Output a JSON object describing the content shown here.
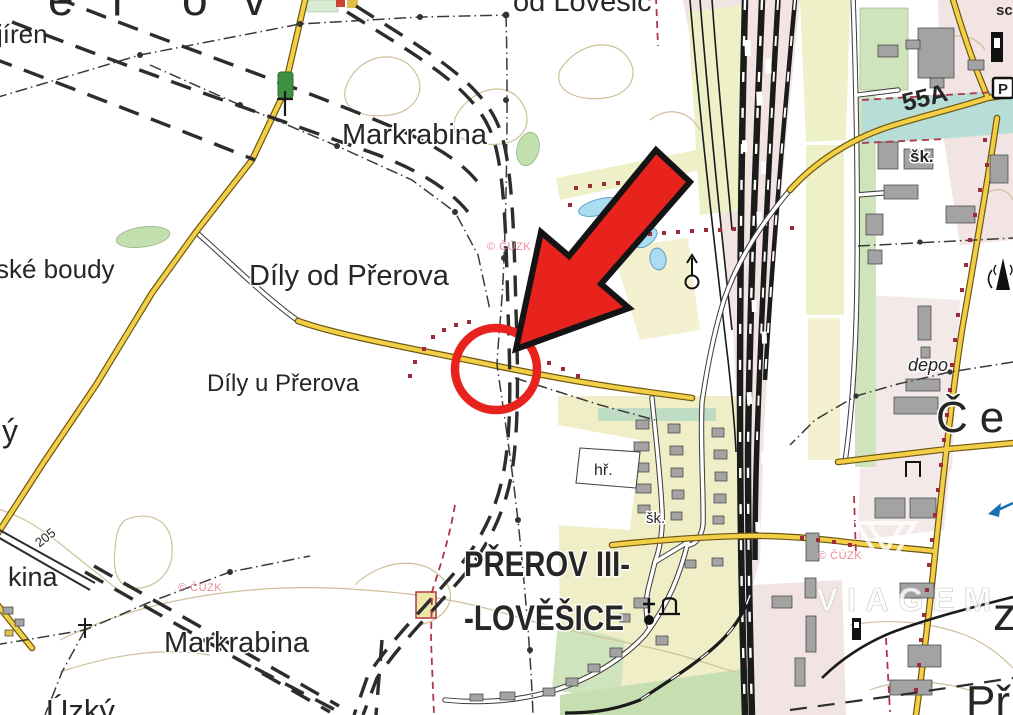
{
  "app": {
    "type": "topographic-map-viewer"
  },
  "attribution": {
    "text": "© ČÚZK",
    "color": "#e98a9b"
  },
  "watermark": {
    "brand": "VIAGEM",
    "color": "#ffffff"
  },
  "annotation": {
    "shape": "circle-and-arrow",
    "color": "#e8231d",
    "outline": "#141414"
  },
  "colors": {
    "road_yellow": "#f2cf46",
    "road_casing": "#6b5712",
    "field_pale": "#f0eec6",
    "field_green": "#cfe4bd",
    "urban_pink": "#f1e4e3",
    "water_blue": "#aadcf2",
    "teal_zone": "#b7ded6",
    "railway_black": "#1b1b1b",
    "boundary_maroon": "#9c2c3c",
    "contour_tan": "#cfc09a"
  },
  "labels": {
    "city_letters": [
      "e",
      "ř",
      "o",
      "v"
    ],
    "top_left_partial": "jíren",
    "field_top": "od Lověšic",
    "markrabina_north": "Markrabina",
    "dily_od": "Díly od Přerova",
    "dily_u": "Díly u Přerova",
    "ske_boudy": "ské boudy",
    "left_partial": "ý",
    "contour_elev": "205",
    "kina_partial": "kina",
    "markrabina_south": "Markrabina",
    "uzky": "Úzký",
    "city_part_line1": "PŘEROV III-",
    "city_part_line2": "-LOVĚŠICE",
    "hriste": "hř.",
    "skola_village": "šk.",
    "skola_town": "šk.",
    "road_number": "55A",
    "depo": "depo",
    "cerna_partial": "Čer",
    "z_partial": "z",
    "pr_partial": "Př",
    "sc_partial": "sc",
    "parking": "P"
  }
}
